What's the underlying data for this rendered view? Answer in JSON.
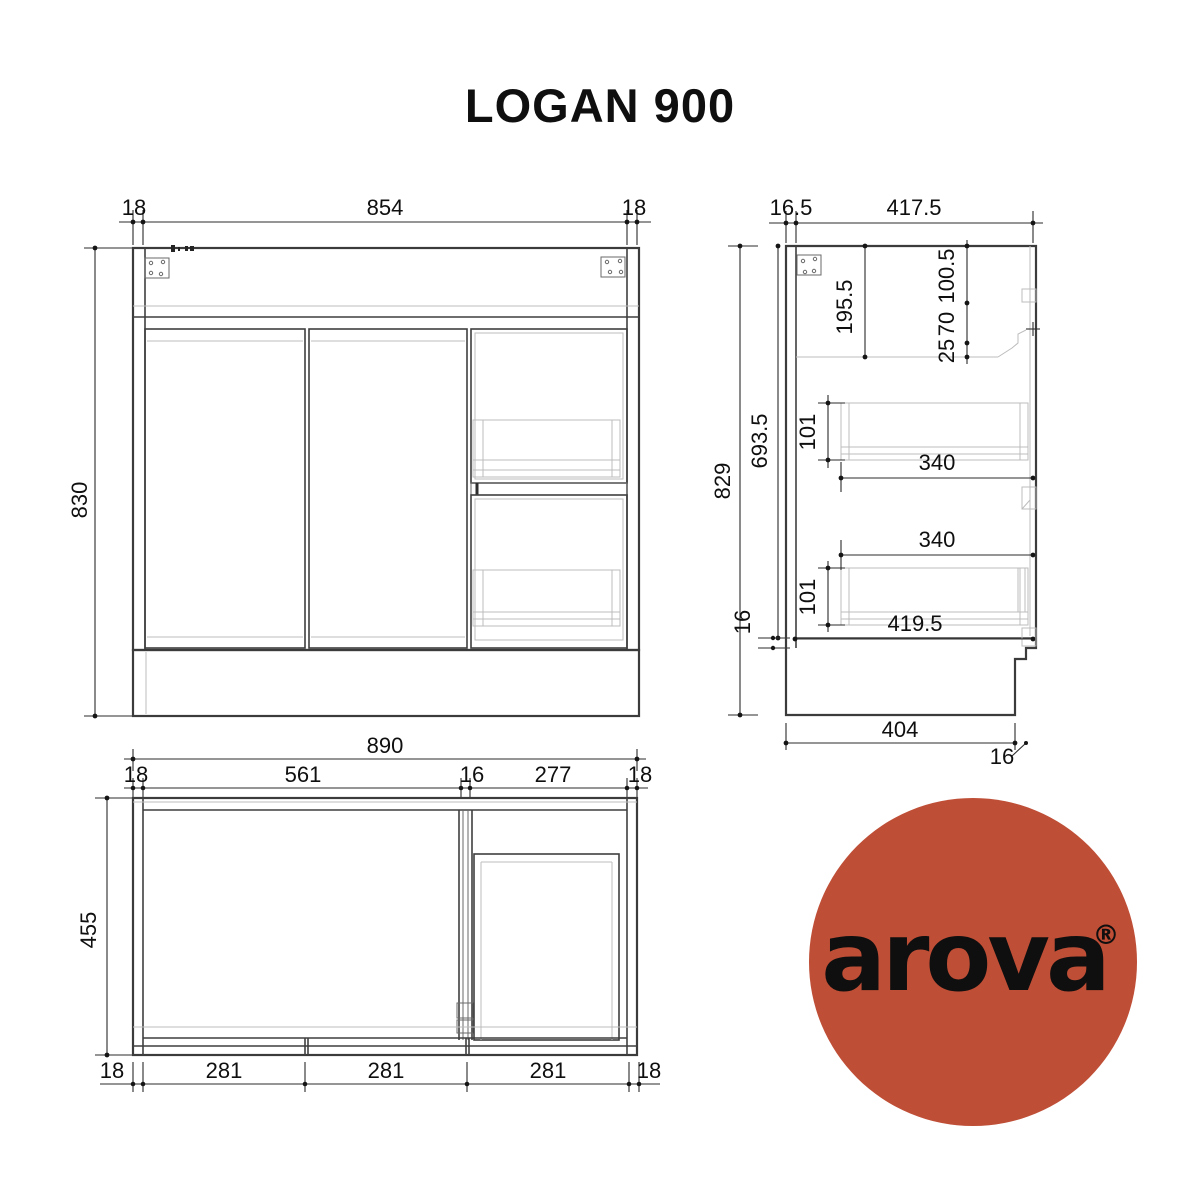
{
  "title": "LOGAN 900",
  "logo": {
    "brand": "arova",
    "registered_mark": "®",
    "circle_color": "#bf4e36",
    "text_color": "#ffffff"
  },
  "front_view": {
    "dims": {
      "top_left_panel": "18",
      "top_width": "854",
      "top_right_panel": "18",
      "overall_height": "830"
    }
  },
  "side_view": {
    "dims": {
      "back_panel": "16.5",
      "top_depth": "417.5",
      "overall_height": "829",
      "interior_height": "693.5",
      "bottom_panel": "16",
      "top_section": "195.5",
      "front_rail": "100.5",
      "rail_gap_upper": "70",
      "rail_gap_lower": "25",
      "drawer_top_height": "101",
      "drawer_top_depth": "340",
      "drawer_bottom_depth": "340",
      "drawer_bottom_height": "101",
      "interior_depth": "419.5",
      "kick_depth": "404",
      "kick_recess": "16"
    }
  },
  "plan_view": {
    "dims": {
      "overall_width": "890",
      "left_panel": "18",
      "door_bay": "561",
      "divider": "16",
      "drawer_bay": "277",
      "right_panel": "18",
      "overall_depth": "455",
      "bottom_left_panel": "18",
      "bay_1": "281",
      "bay_2": "281",
      "bay_3": "281",
      "bottom_right_panel": "18"
    }
  }
}
